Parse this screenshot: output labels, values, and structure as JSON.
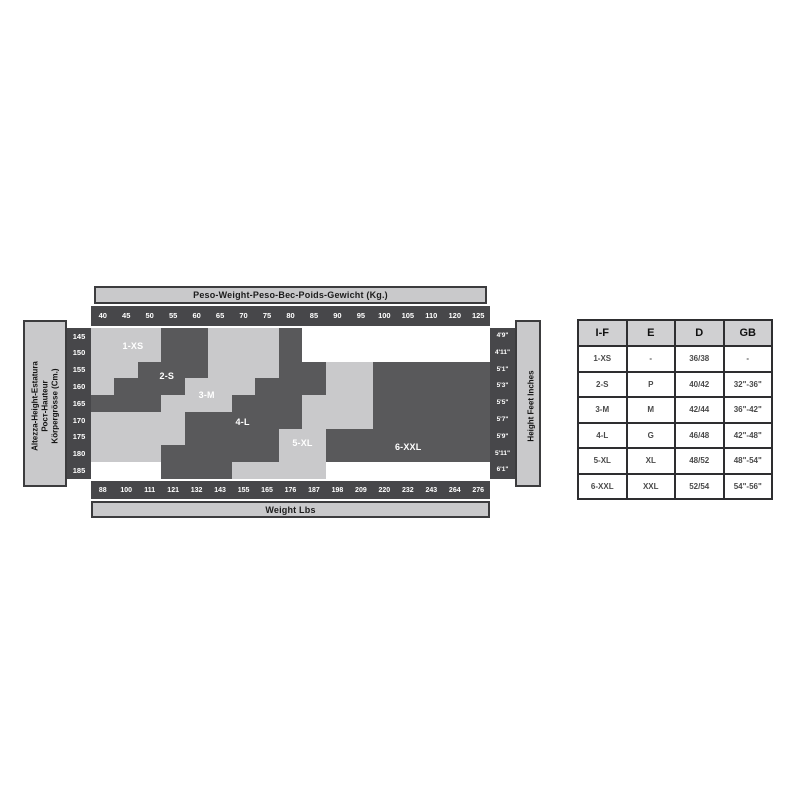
{
  "chart": {
    "kg_header": "Peso-Weight-Peso-Вес-Poids-Gewicht (Kg.)",
    "lbs_footer": "Weight Lbs",
    "height_box_lines": [
      "Altezza-Height-Estatura",
      "Рост-Hauteur",
      "Körpergrösse (Cm.)"
    ],
    "feet_box_label": "Height Feet Inches"
  },
  "chart_data": {
    "type": "heatmap",
    "title": "Peso-Weight-Peso-Вес-Poids-Gewicht (Kg.)",
    "x_axis_top_label": "Peso-Weight-Peso-Вес-Poids-Gewicht (Kg.)",
    "x_axis_bottom_label": "Weight Lbs",
    "y_axis_left_label": "Altezza-Height-Estatura Рост-Hauteur Körpergrösse (Cm.)",
    "y_axis_right_label": "Height Feet Inches",
    "x_kg": [
      "40",
      "45",
      "50",
      "55",
      "60",
      "65",
      "70",
      "75",
      "80",
      "85",
      "90",
      "95",
      "100",
      "105",
      "110",
      "120",
      "125"
    ],
    "x_lbs": [
      "88",
      "100",
      "111",
      "121",
      "132",
      "143",
      "155",
      "165",
      "176",
      "187",
      "198",
      "209",
      "220",
      "232",
      "243",
      "264",
      "276"
    ],
    "y_cm": [
      "145",
      "150",
      "155",
      "160",
      "165",
      "170",
      "175",
      "180",
      "185"
    ],
    "y_feet": [
      "4'9\"",
      "4'11\"",
      "5'1\"",
      "5'3\"",
      "5'5\"",
      "5'7\"",
      "5'9\"",
      "5'11\"",
      "6'1\""
    ],
    "legend": [
      {
        "id": 1,
        "label": "1-XS",
        "shade": "light"
      },
      {
        "id": 2,
        "label": "2-S",
        "shade": "dark"
      },
      {
        "id": 3,
        "label": "3-M",
        "shade": "light"
      },
      {
        "id": 4,
        "label": "4-L",
        "shade": "dark"
      },
      {
        "id": 5,
        "label": "5-XL",
        "shade": "light"
      },
      {
        "id": 6,
        "label": "6-XXL",
        "shade": "dark"
      }
    ],
    "grid_rows_cm_by_kg_size_id": [
      [
        1,
        1,
        1,
        2,
        2,
        3,
        3,
        3,
        4,
        0,
        0,
        0,
        0,
        0,
        0,
        0,
        0
      ],
      [
        1,
        1,
        1,
        2,
        2,
        3,
        3,
        3,
        4,
        0,
        0,
        0,
        0,
        0,
        0,
        0,
        0
      ],
      [
        1,
        1,
        2,
        2,
        2,
        3,
        3,
        3,
        4,
        4,
        5,
        5,
        6,
        6,
        6,
        6,
        6
      ],
      [
        1,
        2,
        2,
        2,
        3,
        3,
        3,
        4,
        4,
        4,
        5,
        5,
        6,
        6,
        6,
        6,
        6
      ],
      [
        2,
        2,
        2,
        3,
        3,
        3,
        4,
        4,
        4,
        5,
        5,
        5,
        6,
        6,
        6,
        6,
        6
      ],
      [
        3,
        3,
        3,
        3,
        4,
        4,
        4,
        4,
        4,
        5,
        5,
        5,
        6,
        6,
        6,
        6,
        6
      ],
      [
        3,
        3,
        3,
        3,
        4,
        4,
        4,
        4,
        5,
        5,
        6,
        6,
        6,
        6,
        6,
        6,
        6
      ],
      [
        3,
        3,
        3,
        4,
        4,
        4,
        4,
        4,
        5,
        5,
        6,
        6,
        6,
        6,
        6,
        6,
        6
      ],
      [
        0,
        0,
        0,
        4,
        4,
        4,
        5,
        5,
        5,
        5,
        0,
        0,
        0,
        0,
        0,
        0,
        0
      ]
    ],
    "size_labels": [
      {
        "text": "1-XS",
        "x_pct": 10.5,
        "y_pct": 12.0
      },
      {
        "text": "2-S",
        "x_pct": 19.0,
        "y_pct": 32.0
      },
      {
        "text": "3-M",
        "x_pct": 29.0,
        "y_pct": 44.5
      },
      {
        "text": "4-L",
        "x_pct": 38.0,
        "y_pct": 62.5
      },
      {
        "text": "5-XL",
        "x_pct": 53.0,
        "y_pct": 76.0
      },
      {
        "text": "6-XXL",
        "x_pct": 79.5,
        "y_pct": 79.0
      }
    ],
    "colors": {
      "light_band": "#c9c9cb",
      "dark_band": "#59595b",
      "axis_strip_bg": "#47474a",
      "axis_strip_text": "#ffffff",
      "header_bar_bg": "#c9c9cb",
      "empty": "#ffffff"
    }
  },
  "size_table": {
    "headers": [
      "I-F",
      "E",
      "D",
      "GB"
    ],
    "rows": [
      [
        "1-XS",
        "-",
        "36/38",
        "-"
      ],
      [
        "2-S",
        "P",
        "40/42",
        "32\"-36\""
      ],
      [
        "3-M",
        "M",
        "42/44",
        "36\"-42\""
      ],
      [
        "4-L",
        "G",
        "46/48",
        "42\"-48\""
      ],
      [
        "5-XL",
        "XL",
        "48/52",
        "48\"-54\""
      ],
      [
        "6-XXL",
        "XXL",
        "52/54",
        "54\"-56\""
      ]
    ]
  }
}
